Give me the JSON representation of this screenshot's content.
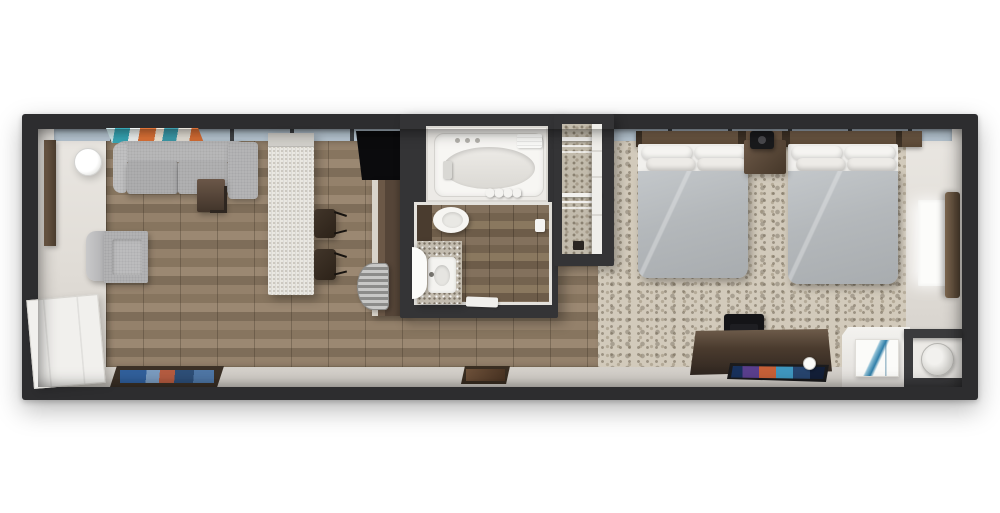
{
  "scene": {
    "type": "3d-floor-plan-render",
    "subject": "Top-down 3D floor plan of a hotel studio suite: living room with sofa and kitchenette, bathroom with tub, walk-in closet, and bedroom with two double beds",
    "background_color": "#ffffff"
  },
  "palette": {
    "wall": "#2d2d2f",
    "window_band": "#b9c8d4",
    "wood_floor": "#8c7964",
    "bathroom_floor": "#7b6a57",
    "entry_floor": "#e3e0da",
    "carpet": "#d2cabb",
    "carpet_fleck": "#6e6453",
    "sofa_gray": "#b2b2b3",
    "bed_duvet": "#b4b8bb",
    "pillow_white": "#f5f4f1",
    "headboard_wood": "#6a5846",
    "island_counter": "#e9e7e1",
    "dark_cabinet": "#4a3b2c",
    "tv_black": "#0b0b0d",
    "curtain_wood": "#6f5a45",
    "art_teal": "#38a7b6",
    "art_orange": "#e07438",
    "art_blue": "#2f7ea8"
  },
  "labels": {
    "unit": "Hotel suite floor plan",
    "window_band": "Window wall",
    "wood_floor": "Wood plank floor",
    "carpet": "Patterned bedroom carpet",
    "wall_mirror": "Wall mirror",
    "floor_lamp": "Floor lamp",
    "wall_art": "Abstract wall art",
    "sofa": "Sofa",
    "side_table": "Side table",
    "armchair": "Armchair",
    "entry_door": "Entry door",
    "entry_mat": "Entry door mat",
    "kitchen_island": "Kitchen island counter",
    "bar_stool": "Bar stool",
    "wall_tv": "Wall-mounted TV",
    "kitchen_counter": "Kitchenette counter",
    "kitchen_sink": "Kitchen sink",
    "bathroom": "Bathroom",
    "bathtub": "Bathtub",
    "shower_jets": "Shower jets",
    "towel": "Folded towel",
    "tub_faucet": "Tub faucet",
    "shower_curtain": "Shower curtain",
    "toilet": "Toilet",
    "vanity": "Vanity counter",
    "sink": "Vanity sink",
    "round_mirror": "Round mirror",
    "door_sill": "Bath mat",
    "door_handle": "Bathroom door handle",
    "closet": "Walk-in closet",
    "wire_shelf": "Wire closet shelf",
    "closet_item": "Closet item",
    "headboard": "Headboard panel",
    "bed": "Double bed",
    "nightstand": "Nightstand",
    "table_lamp": "Table lamp",
    "desk": "Desk dresser",
    "desk_chair": "Desk chair",
    "desk_tv": "Flat-screen TV",
    "coffee_cup": "Coffee cup",
    "window": "Bedroom window",
    "curtain": "Curtain panel",
    "console_table": "Console cabinet",
    "framed_art": "Framed art print",
    "cube_table": "Cube side table",
    "hall_mat": "Hallway mat"
  },
  "rooms": [
    {
      "name": "living-area",
      "floor": "wood",
      "furniture": [
        "sofa",
        "side-table",
        "armchair",
        "floor-lamp",
        "wall-art",
        "wall-mirror",
        "entry-door",
        "entry-mat",
        "kitchen-island",
        "bar-stool",
        "bar-stool",
        "wall-tv",
        "kitchen-counter",
        "kitchen-sink"
      ]
    },
    {
      "name": "bathroom",
      "floor": "wood",
      "furniture": [
        "bathtub",
        "toilet",
        "vanity",
        "sink",
        "round-mirror",
        "towel",
        "shower-curtain"
      ]
    },
    {
      "name": "closet",
      "floor": "carpet",
      "furniture": [
        "wire-shelves"
      ]
    },
    {
      "name": "bedroom",
      "floor": "carpet",
      "furniture": [
        "double-bed",
        "double-bed",
        "nightstand",
        "table-lamp",
        "headboard",
        "desk",
        "desk-chair",
        "flat-tv",
        "window",
        "curtain",
        "console-table",
        "framed-art",
        "cube-table"
      ]
    },
    {
      "name": "hallway",
      "floor": "light-tile",
      "furniture": [
        "hall-mat"
      ]
    }
  ]
}
